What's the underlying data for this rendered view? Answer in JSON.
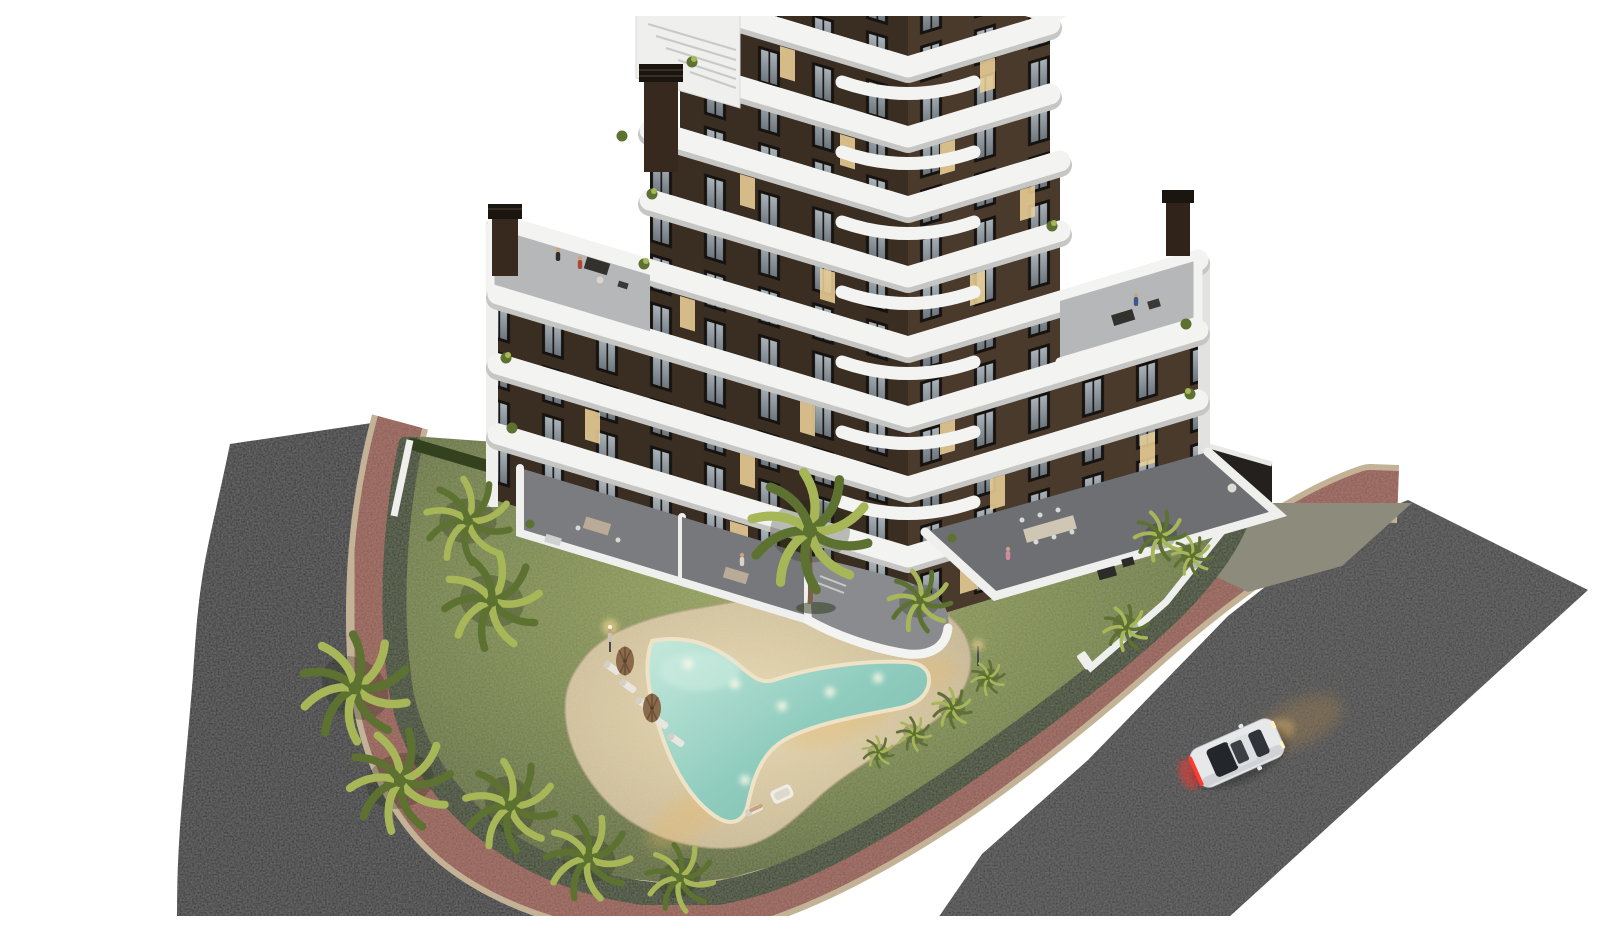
{
  "scene": {
    "description": "Aerial dusk 3D architectural render of a V-shaped apartment block with zigzag white balcony bands, garden with boomerang pool, palm trees, terracotta sidewalks, asphalt streets and one white car driving with lights on",
    "background": "#ffffff"
  },
  "palette": {
    "bg": "#ffffff",
    "asphalt": "#3b3a3c",
    "asphaltDark": "#333235",
    "sidewalk": "#91544a",
    "curb": "#c3b296",
    "grass1": "#95a154",
    "grass2": "#6d7c38",
    "grass3": "#47521f",
    "hedge": "#33411f",
    "palm1": "#a7b757",
    "palm2": "#5d7231",
    "trunk": "#7a6148",
    "sand1": "#e7d7ae",
    "sand2": "#c2b18b",
    "pool1": "#c5e9dc",
    "pool2": "#8fccbe",
    "pool3": "#78b9ac",
    "coping": "#eee3c6",
    "facadeL": "#3a2d22",
    "facadeR": "#4a3a2b",
    "band": "#f3f3f1",
    "bandShadow": "#c6c6c4",
    "glass1": "#a9b2b8",
    "glass2": "#6e777e",
    "winFrame": "#15120f",
    "lit": "#e9cf96",
    "terraceFloor": "#7b7c7f",
    "roofTerrace": "#b6b7b9",
    "wall": "#efefed",
    "concrete": "#8d8b7c",
    "garage": "#23201d",
    "chimney": "#38291e",
    "chimneyCap": "#1b1510",
    "carBody": "#e6e8ea",
    "carGlass": "#23262b",
    "tail": "#ff3b30",
    "head": "#fff3c4",
    "beam": "#9a7d50",
    "lampGlow": "#ffdf9e",
    "rock": "#8f928d",
    "bed": "#b7a88a",
    "pathGray": "#9a9a98",
    "skin": "#caa27e"
  },
  "building": {
    "plan_shape": "v-chevron",
    "balcony_bands": 8,
    "floors_visible": 8,
    "rooftop_terraces": 2,
    "chimneys": 3,
    "facade_material": "dark brown",
    "band_material": "white curved balconies"
  },
  "garden": {
    "pool_shape": "boomerang",
    "underwater_lights": 6,
    "sun_loungers": 7,
    "parasols": 2,
    "palm_trees": 16,
    "planting_island": 1,
    "hedge_perimeter": true
  },
  "street": {
    "roads": 2,
    "sidewalk_color_name": "terracotta",
    "vehicle": {
      "type": "coupe",
      "color_name": "white",
      "lights": "on",
      "count": 1
    }
  },
  "people_visible": 7
}
